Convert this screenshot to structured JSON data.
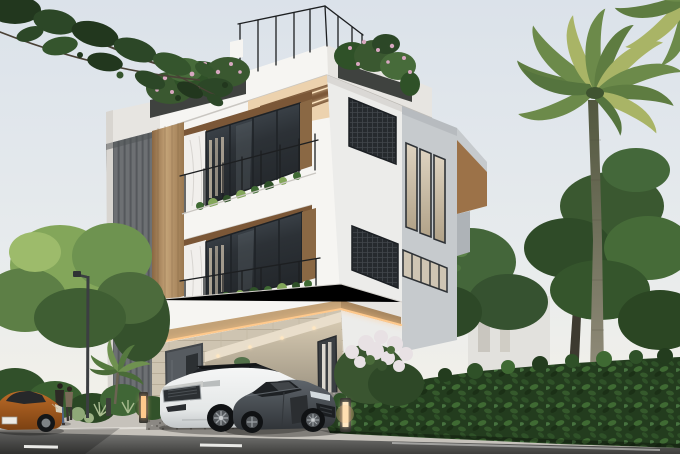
{
  "scene": {
    "description": "Photorealistic 3D exterior rendering of a modern three-story white villa at dusk, with warm LED accent lighting, rooftop terrace planters, two cars parked in the driveway, a street in the foreground and tropical landscaping with palm trees and hedges",
    "type": "architectural visualization",
    "time_of_day": "overcast dusk with warm artificial lighting"
  },
  "colors": {
    "sky_top": "#dbe2ea",
    "sky_low": "#eef0ef",
    "sky_horizon": "#f6f2e8",
    "white_lit": "#f6f5f2",
    "white_shade": "#e7e5e1",
    "white_dark": "#d8d5d0",
    "slat_dark": "#6d7073",
    "slat_line": "#55585c",
    "wood_light": "#c3a277",
    "wood_dark": "#8a6844",
    "soffit_wood": "#7b5737",
    "led_warm": "#ffc98c",
    "led_bright": "#ffe7c2",
    "glass_dark": "#2f343a",
    "curtain": "#d5c8b2",
    "grille_dark": "#262a2e",
    "gray_face": "#c6cacd",
    "gray_face_dark": "#aeb3b7",
    "marble": "#f1efec",
    "stone": "#cec4b1",
    "stone_line": "#b9ae9a",
    "railing_black": "#1d1f21",
    "road_gray": "#6c6c6a",
    "road_dark": "#454543",
    "lane_white": "#e9e9e6",
    "sidewalk_gray": "#c6c2bb",
    "curb_light": "#dedbd4",
    "gravel_gray": "#8d8a84",
    "hedge_dark": "#233c1e",
    "hedge_mid": "#2f5128",
    "hedge_light": "#3f6a33",
    "tree_dark": "#26391f",
    "tree_mid": "#3a5830",
    "tree_light": "#83a65a",
    "palm_green": "#6c8a4a",
    "palm_yellow": "#a9b466",
    "palm_trunk": "#837e6d",
    "suv_white": "#eff1f1",
    "car_black": "#1b1d1f",
    "sport_gray": "#4b5055",
    "sedan_orange": "#ad5d22",
    "jeans_blue": "#4f6383",
    "flower_pink": "#d8a7c0",
    "blossom_white": "#e8e1e4"
  },
  "building": {
    "kind": "modern villa",
    "stories": 3,
    "roof_terrace": {
      "railing": "thin black metal",
      "planters": 2,
      "planting": "green shrubs with pink flowers spilling over the fascia"
    },
    "balconies": [
      {
        "level": 3,
        "glass_doors": "dark-framed sliding glass with sheer curtains",
        "railing": "black metal",
        "edge_planting": "small green shrubs",
        "ceiling": "dark wood soffit with LED perimeter strip"
      },
      {
        "level": 2,
        "glass_doors": "dark-framed sliding glass with sheer curtains",
        "railing": "black metal",
        "edge_planting": "small green shrubs",
        "ceiling": "dark wood soffit with recessed lights"
      }
    ],
    "materials": [
      "white plaster",
      "vertical gray slat cladding",
      "warm wood panel column",
      "white marble panel",
      "travertine stone base",
      "dark metal grille panels"
    ],
    "accent_lighting": "warm LED strips under fascias, along wood column edges and carport ceiling",
    "grille_panels": 2,
    "right_wing": {
      "facade": "light gray textured plaster",
      "tall_windows": 3,
      "clerestory_band_panes": 5,
      "niche": "cantilevered block with wood soffit"
    },
    "ground_floor": {
      "entry_door": "dark gray metal door",
      "carport": {
        "ceiling_lights": 4,
        "back_wall": "lit travertine with curtained window"
      }
    }
  },
  "vehicles": {
    "white_suv": {
      "type": "luxury SUV",
      "body_color": "white",
      "roof": "black",
      "facing": "left",
      "wheels": "dark multi-spoke"
    },
    "sports_car": {
      "type": "low two-seat sports coupe",
      "body_color": "dark gray",
      "facing": "right toward street",
      "wheels": "dark with silver rims"
    },
    "orange_sedan": {
      "type": "luxury sedan at street edge",
      "body_color": "burnt orange",
      "license_plate": "white, illegible",
      "facing": "right"
    }
  },
  "people": {
    "count": 2,
    "description": "couple walking on the sidewalk, front figure in dark jacket and blue jeans"
  },
  "vegetation": {
    "overhanging_tree": "dark green feathery branches entering from top-left",
    "left_trees": "light green and mid green canopies along the street",
    "palm_trees": {
      "count": 2,
      "position": "right of the villa, one crown partly off-frame top-right"
    },
    "hedge": "dense clipped leafy hedge along the right property line",
    "flowering_bush": "white blossom shrub at the villa's right corner",
    "foreground_bushes": "round shrubs, pale ornamental grasses and a small fan palm left of the driveway"
  },
  "street": {
    "road": {
      "surface": "asphalt",
      "markings": "dashed white center line"
    },
    "sidewalk": "light concrete with curb",
    "driveway": "dark gravel apron",
    "furniture": {
      "street_lamp": 1,
      "bollard_lights_lit": 2,
      "bollard_dark": 1
    }
  }
}
